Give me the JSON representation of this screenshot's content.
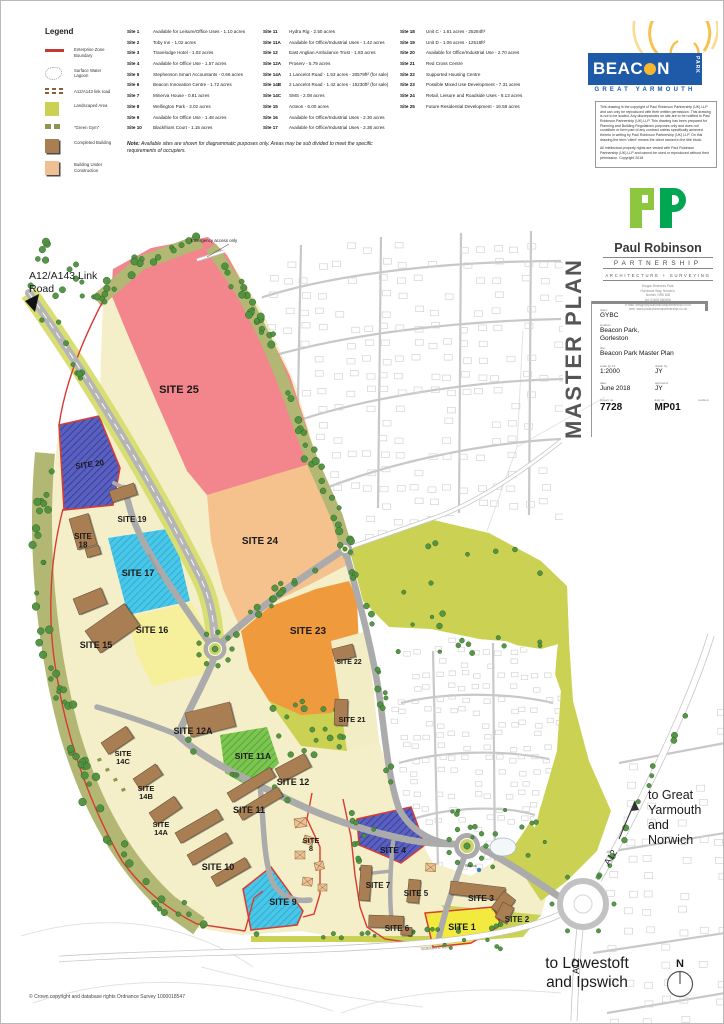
{
  "legend": {
    "title": "Legend",
    "items": [
      {
        "swatch": "ez-line",
        "label": "Enterprise Zone\nBoundary"
      },
      {
        "swatch": "lagoon",
        "label": "Surface Water\nLagoon"
      },
      {
        "swatch": "link-road",
        "label": "A12/A143 link road"
      },
      {
        "swatch": "landscaped",
        "label": "Landscaped Area"
      },
      {
        "swatch": "green-gym",
        "label": "\"Green Gym\""
      },
      {
        "swatch": "completed",
        "label": "Completed Building"
      },
      {
        "swatch": "construction",
        "label": "Building Under\nConstruction"
      }
    ]
  },
  "site_lists": {
    "col1": [
      {
        "id": "Site 1",
        "desc": "Available for Leisure/Office Uses - 1.10 acres"
      },
      {
        "id": "Site 2",
        "desc": "Toby Inn - 1.02 acres"
      },
      {
        "id": "Site 3",
        "desc": "Travelodge Hotel - 1.02 acres"
      },
      {
        "id": "Site 4",
        "desc": "Available for Office Use - 1.57 acres"
      },
      {
        "id": "Site 5",
        "desc": "Stephenson Smart Accountants - 0.66 acres"
      },
      {
        "id": "Site 6",
        "desc": "Beacon Innovation Centre - 1.72 acres"
      },
      {
        "id": "Site 7",
        "desc": "Minerva House - 0.81 acres"
      },
      {
        "id": "Site 8",
        "desc": "Wellington Park - 3.02 acres"
      },
      {
        "id": "Site 9",
        "desc": "Available for Office Use - 1.48 acres"
      },
      {
        "id": "Site 10",
        "desc": "Blackfriars Court - 1.15 acres"
      }
    ],
    "col2": [
      {
        "id": "Site 11",
        "desc": "Hydra Rig - 2.50 acres"
      },
      {
        "id": "Site 11A",
        "desc": "Available for Office/Industrial Uses - 1.42 acres"
      },
      {
        "id": "Site 12",
        "desc": "East Anglian Ambulance Trust - 1.83 acres"
      },
      {
        "id": "Site 12A",
        "desc": "Proserv - 5.79 acres"
      },
      {
        "id": "Site 14A",
        "desc": "1 Lancelot Road - 1.53 acres - 20579ft² (for sale)"
      },
      {
        "id": "Site 14B",
        "desc": "2 Lancelot Road - 1.42 acres - 15230ft² (for sale)"
      },
      {
        "id": "Site 14C",
        "desc": "SMS - 2.08 acres"
      },
      {
        "id": "Site 15",
        "desc": "Acteon - 6.00 acres"
      },
      {
        "id": "Site 16",
        "desc": "Available for Office/Industrial Uses - 2.30 acres"
      },
      {
        "id": "Site 17",
        "desc": "Available for Office/Industrial Uses - 2.38 acres"
      }
    ],
    "col3": [
      {
        "id": "Site 18",
        "desc": "Unit C - 1.61 acres - 25284ft²"
      },
      {
        "id": "Site 19",
        "desc": "Unit D - 1.06 acres - 12518ft²"
      },
      {
        "id": "Site 20",
        "desc": "Available for Office/Industrial Use - 2.70 acres"
      },
      {
        "id": "Site 21",
        "desc": "Red Cross Centre"
      },
      {
        "id": "Site 22",
        "desc": "Supported Housing Centre"
      },
      {
        "id": "Site 23",
        "desc": "Possible Mixed Use Development - 7.31 acres"
      },
      {
        "id": "Site 24",
        "desc": "Retail, Leisure and Roadside Uses - 8.13 acres"
      },
      {
        "id": "Site 25",
        "desc": "Future Residential Development - 16.58 acres"
      }
    ]
  },
  "note": {
    "bold": "Note:",
    "text": " Available sites are shown for diagrammatic purposes only. Areas may be sub divided to meet the specific requirements of occupiers."
  },
  "branding": {
    "beacon": {
      "name1": "BEAC",
      "name2": "N",
      "park": "PARK",
      "sub": "GREAT YARMOUTH"
    },
    "copyright_p1": "This drawing is the copyright of Paul Robinson Partnership (UK) LLP and can only be reproduced with their written permission. This drawing is not to be scaled. Any discrepancies on site are to be notified to Paul Robinson Partnership (UK) LLP. This drawing has been prepared for Planning and Building Regulations purposes only and does not constitute or form part of any contract unless specifically annexed thereto in writing by Paul Robinson Partnership (UK) LLP. On this drawing the term 'client' means the client named in the title block.",
    "copyright_p2": "All intellectual property rights are vested with Paul Robinson Partnership (UK) LLP and cannot be used or reproduced without their permission. Copyright 2018",
    "prp": {
      "name": "Paul Robinson",
      "partnership": "PARTNERSHIP",
      "tagline": "ARCHITECTURE  +  SURVEYING",
      "addr": "Dragon Business Park,\nHurricane Way, Norwich,\nNorfolk, NR6 6JB\ntel: 01603 660406\ne-mail: design@paulrobinsonpartnership.co.uk\nweb: www.paulrobinsonpartnership.co.uk"
    }
  },
  "title_block": {
    "side_title": "MASTER PLAN",
    "client_label": "client:",
    "client": "GYBC",
    "location_label": "location:",
    "location1": "Beacon Park,",
    "location2": "Gorleston",
    "title_label": "title:",
    "title": "Beacon Park Master Plan",
    "scale_label": "scale @ A1:",
    "scale": "1:2000",
    "drawn_label": "drawn by:",
    "drawn": "JY",
    "date_label": "date:",
    "date": "June 2018",
    "approved_label": "approved:",
    "approved": "JY",
    "project_label": "project no:",
    "project": "7728",
    "dwg_label": "dwg no:",
    "dwg": "MP01",
    "revision_label": "revision:"
  },
  "footer": {
    "os_credit": "© Crown copyright and database rights Ordnance Survey 1000018547"
  },
  "map": {
    "colors": {
      "pink": "#F2868C",
      "peach": "#F5C28E",
      "orange": "#F09A3E",
      "blue": "#5A60BE",
      "cyan": "#4AC7E8",
      "greenH": "#7CC550",
      "paleYellow": "#F6EF9C",
      "yellow": "#F2EA3E",
      "cream": "#F4EFC8",
      "cream2": "#F2EDC5",
      "land": "#CBD253",
      "olive": "#B2B873",
      "verge": "#D8DE71",
      "tree": "#4F9140",
      "treeEdge": "#2C6423",
      "road": "#ABABAB",
      "building": "#A87E52",
      "construction": "#EFC192",
      "red": "#D93A32",
      "blueDot": "#3E7EC2"
    },
    "sites": [
      {
        "id": "site-25",
        "t": "SITE 25",
        "pts": "112,268 150,247 207,236 226,254 258,312 289,375 307,430 312,462 262,480 206,494 186,470 156,402 126,332 110,293",
        "fill": "pink",
        "lx": 178,
        "ly": 392,
        "fs": 11
      },
      {
        "id": "site-24",
        "t": "SITE 24",
        "pts": "206,494 312,462 338,518 350,562 308,584 262,606 237,622 222,588 210,540",
        "fill": "peach",
        "lx": 259,
        "ly": 543,
        "fs": 10
      },
      {
        "id": "site-23",
        "t": "SITE 23",
        "pts": "240,630 268,606 315,588 348,580 356,598 358,648 352,700 330,712 300,714 268,700 248,668",
        "fill": "orange",
        "lx": 307,
        "ly": 633,
        "fs": 10
      },
      {
        "id": "strip-21-22",
        "t": "",
        "pts": "330,640 366,630 378,740 346,750",
        "fill": "cream2"
      },
      {
        "id": "site-20",
        "t": "SITE 20",
        "pts": "58,424 98,415 119,467 112,504 63,509",
        "fill": "blue",
        "hatch": "hB",
        "stroke": "red",
        "lx": 89,
        "ly": 466,
        "fs": 8,
        "rot": -8
      },
      {
        "id": "site-17",
        "t": "SITE 17",
        "pts": "107,537 172,527 189,600 127,614",
        "fill": "cyan",
        "hatch": "hC",
        "lx": 137,
        "ly": 575,
        "fs": 9
      },
      {
        "id": "site-16",
        "t": "SITE 16",
        "pts": "127,616 191,602 212,646 206,672 152,685 136,654",
        "fill": "paleYellow",
        "lx": 151,
        "ly": 632,
        "fs": 9
      },
      {
        "id": "site-11a",
        "t": "SITE 11A",
        "pts": "219,734 266,726 278,762 252,788 224,772",
        "fill": "greenH",
        "hatch": "hG",
        "lx": 252,
        "ly": 758,
        "fs": 8.5
      },
      {
        "id": "site-9",
        "t": "SITE 9",
        "pts": "242,888 270,866 302,910 296,924 250,929",
        "fill": "cyan",
        "hatch": "hC",
        "stroke": "red",
        "lx": 282,
        "ly": 904,
        "fs": 9
      },
      {
        "id": "site-4",
        "t": "SITE 4",
        "pts": "356,818 410,806 424,844 400,862 382,854 358,844",
        "fill": "blue",
        "hatch": "hB",
        "stroke": "red",
        "lx": 392,
        "ly": 852,
        "fs": 8.5
      },
      {
        "id": "site-1",
        "t": "SITE 1",
        "pts": "424,912 492,906 500,924 470,942 432,946",
        "fill": "yellow",
        "stroke": "red",
        "lx": 461,
        "ly": 929,
        "fs": 9
      }
    ],
    "labels": [
      {
        "t": "SITE 19",
        "x": 131,
        "y": 521,
        "fs": 8,
        "b": 1
      },
      {
        "t": "SITE\n18",
        "x": 82,
        "y": 538,
        "fs": 8,
        "b": 1
      },
      {
        "t": "SITE 15",
        "x": 95,
        "y": 647,
        "fs": 9,
        "b": 1
      },
      {
        "t": "SITE 12A",
        "x": 192,
        "y": 733,
        "fs": 9,
        "b": 1
      },
      {
        "t": "SITE 12",
        "x": 292,
        "y": 784,
        "fs": 9,
        "b": 1
      },
      {
        "t": "SITE 11",
        "x": 248,
        "y": 812,
        "fs": 9,
        "b": 1
      },
      {
        "t": "SITE\n14C",
        "x": 122,
        "y": 755,
        "fs": 7.5,
        "b": 1
      },
      {
        "t": "SITE\n14B",
        "x": 145,
        "y": 790,
        "fs": 7.5,
        "b": 1
      },
      {
        "t": "SITE\n14A",
        "x": 160,
        "y": 826,
        "fs": 7.5,
        "b": 1
      },
      {
        "t": "SITE 10",
        "x": 217,
        "y": 869,
        "fs": 9,
        "b": 1
      },
      {
        "t": "SITE\n8",
        "x": 310,
        "y": 842,
        "fs": 7.5,
        "b": 1
      },
      {
        "t": "SITE 22",
        "x": 348,
        "y": 663,
        "fs": 7,
        "b": 1
      },
      {
        "t": "SITE 21",
        "x": 351,
        "y": 721,
        "fs": 7.5,
        "b": 1
      },
      {
        "t": "SITE 7",
        "x": 377,
        "y": 887,
        "fs": 8,
        "b": 1
      },
      {
        "t": "SITE 5",
        "x": 415,
        "y": 895,
        "fs": 8,
        "b": 1
      },
      {
        "t": "SITE 6",
        "x": 396,
        "y": 930,
        "fs": 8,
        "b": 1
      },
      {
        "t": "SITE 3",
        "x": 480,
        "y": 900,
        "fs": 8.5,
        "b": 1
      },
      {
        "t": "SITE 2",
        "x": 516,
        "y": 921,
        "fs": 8,
        "b": 1
      },
      {
        "t": "A12/A143 Link",
        "x": 28,
        "y": 278,
        "fs": 10.5,
        "a": "start"
      },
      {
        "t": "Road",
        "x": 28,
        "y": 291,
        "fs": 10.5,
        "a": "start"
      },
      {
        "t": "to Great",
        "x": 647,
        "y": 798,
        "fs": 12.5,
        "a": "start"
      },
      {
        "t": "Yarmouth",
        "x": 647,
        "y": 813,
        "fs": 12.5,
        "a": "start"
      },
      {
        "t": "and",
        "x": 647,
        "y": 828,
        "fs": 12.5,
        "a": "start"
      },
      {
        "t": "Norwich",
        "x": 647,
        "y": 843,
        "fs": 12.5,
        "a": "start"
      },
      {
        "t": "to Lowestoft",
        "x": 586,
        "y": 967,
        "fs": 15.5
      },
      {
        "t": "and Ipswich",
        "x": 586,
        "y": 986,
        "fs": 15.5
      },
      {
        "t": "A12",
        "x": 612,
        "y": 858,
        "fs": 9,
        "rot": -58
      },
      {
        "t": "A12",
        "x": 578,
        "y": 965,
        "fs": 9,
        "rot": -90
      },
      {
        "t": "SIDEGATE ROAD",
        "x": 436,
        "y": 948,
        "fs": 4,
        "rot": -5,
        "c": "#808080"
      },
      {
        "t": "BEAUFORT WAY",
        "x": 153,
        "y": 566,
        "fs": 3.6,
        "rot": 62,
        "c": "#8a8a8a"
      },
      {
        "t": "Emergency access only",
        "x": 213,
        "y": 241,
        "fs": 4.4
      },
      {
        "t": "Beacon",
        "x": 470,
        "y": 866,
        "fs": 3.4,
        "c": "#444"
      },
      {
        "t": "N",
        "x": 679,
        "y": 966,
        "fs": 11,
        "b": 1
      }
    ]
  }
}
